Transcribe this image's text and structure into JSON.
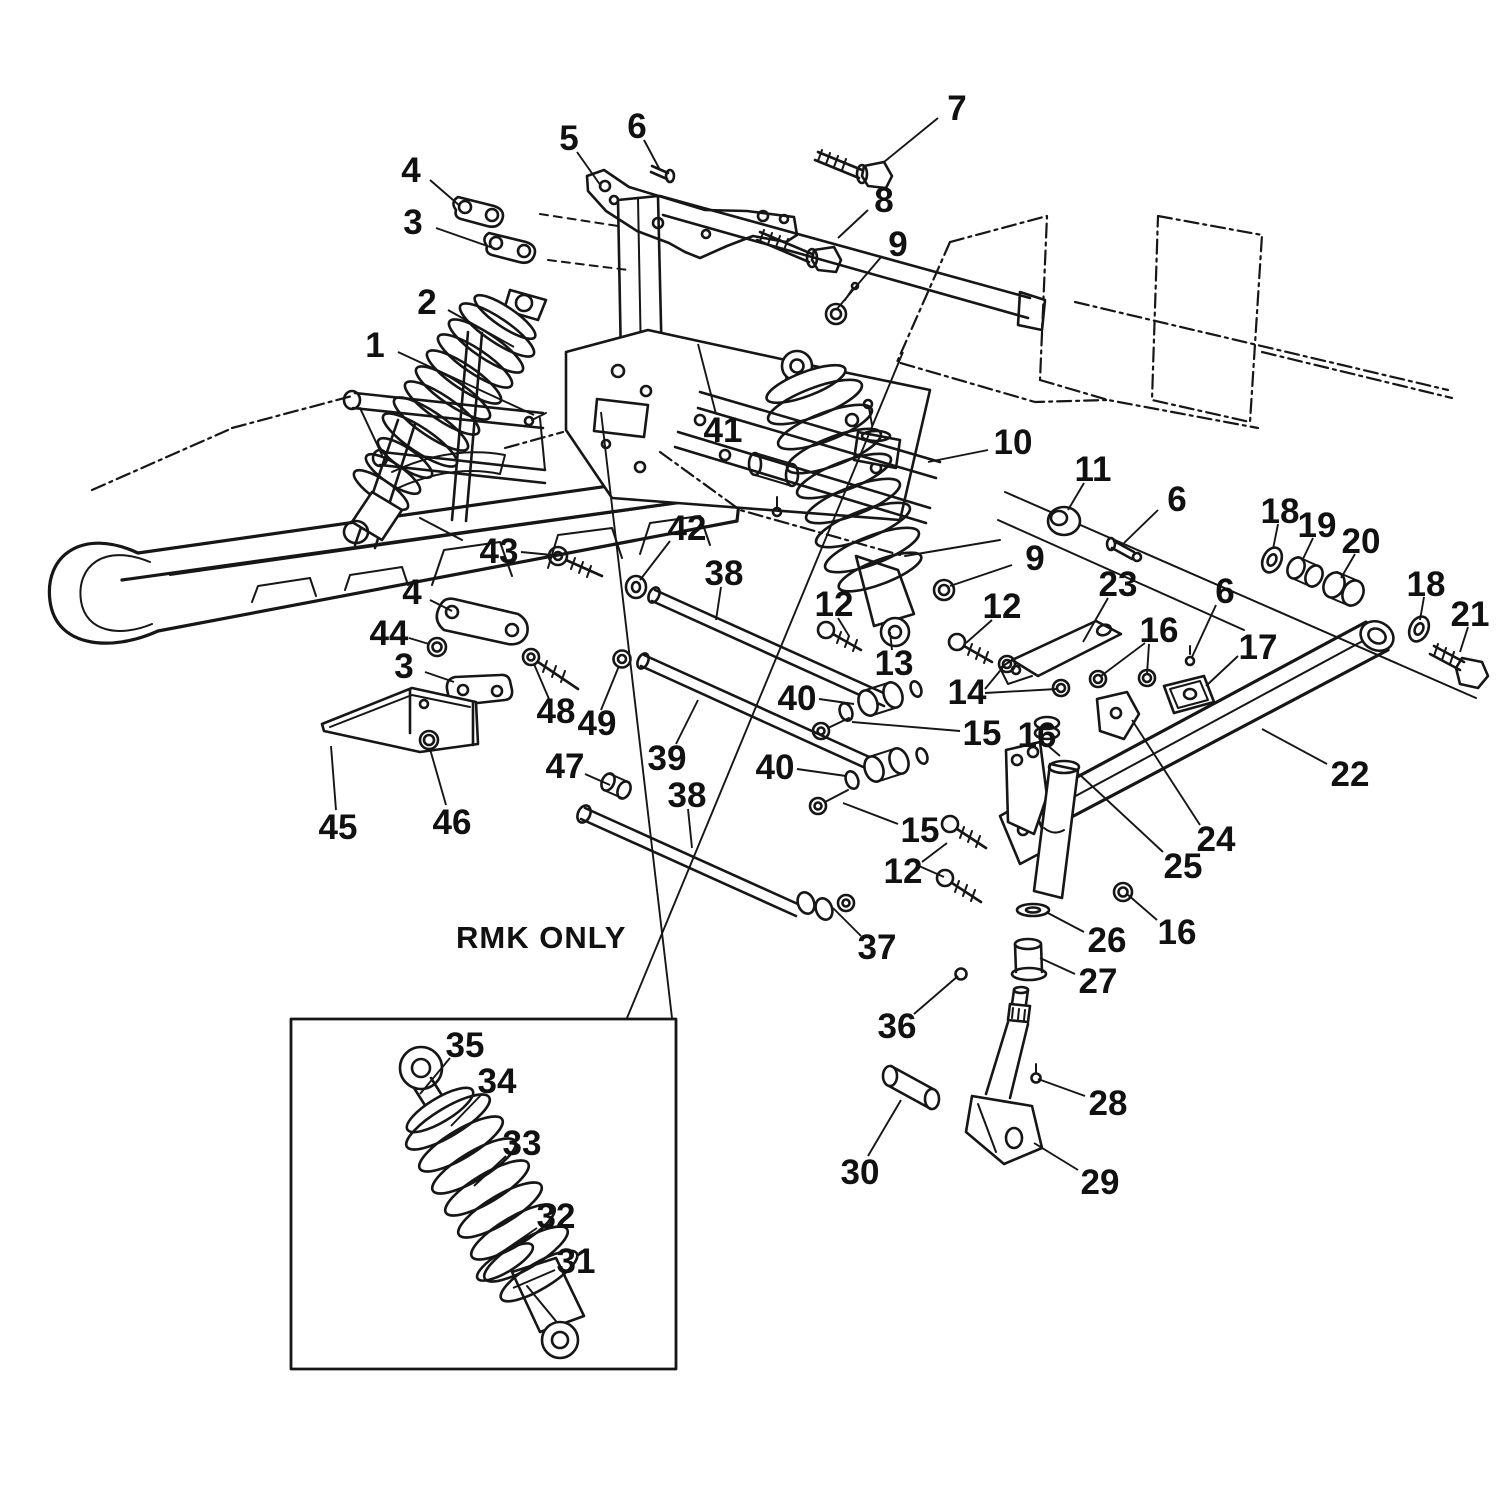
{
  "figure": {
    "note": "RMK ONLY",
    "background": "#ffffff",
    "line_color": "#161616"
  },
  "inset": {
    "x": 291,
    "y": 1019,
    "w": 385,
    "h": 350
  },
  "callouts": [
    {
      "n": "1",
      "x": 375,
      "y": 345,
      "lx": 398,
      "ly": 352,
      "tx": 534,
      "ty": 415
    },
    {
      "n": "2",
      "x": 427,
      "y": 302,
      "lx": 448,
      "ly": 310,
      "tx": 514,
      "ty": 347
    },
    {
      "n": "3",
      "x": 413,
      "y": 222,
      "lx": 436,
      "ly": 228,
      "tx": 496,
      "ty": 249
    },
    {
      "n": "4",
      "x": 411,
      "y": 170,
      "lx": 430,
      "ly": 180,
      "tx": 460,
      "ty": 206
    },
    {
      "n": "5",
      "x": 569,
      "y": 138,
      "lx": 577,
      "ly": 152,
      "tx": 601,
      "ty": 186
    },
    {
      "n": "6",
      "x": 637,
      "y": 126,
      "lx": 644,
      "ly": 140,
      "tx": 660,
      "ty": 170
    },
    {
      "n": "7",
      "x": 957,
      "y": 108,
      "lx": 938,
      "ly": 118,
      "tx": 884,
      "ty": 162
    },
    {
      "n": "8",
      "x": 884,
      "y": 200,
      "lx": 868,
      "ly": 210,
      "tx": 838,
      "ty": 238
    },
    {
      "n": "9",
      "x": 898,
      "y": 244,
      "lx": 882,
      "ly": 256,
      "tx": 836,
      "ty": 310
    },
    {
      "n": "10",
      "x": 1013,
      "y": 442,
      "lx": 988,
      "ly": 450,
      "tx": 928,
      "ty": 462
    },
    {
      "n": "11",
      "x": 1093,
      "y": 469,
      "lx": 1084,
      "ly": 483,
      "tx": 1068,
      "ty": 510
    },
    {
      "n": "6",
      "x": 1177,
      "y": 499,
      "lx": 1158,
      "ly": 510,
      "tx": 1124,
      "ty": 543
    },
    {
      "n": "9",
      "x": 1035,
      "y": 558,
      "lx": 1012,
      "ly": 565,
      "tx": 950,
      "ty": 586
    },
    {
      "n": "23",
      "x": 1118,
      "y": 584,
      "lx": 1108,
      "ly": 598,
      "tx": 1083,
      "ty": 642
    },
    {
      "n": "12",
      "x": 834,
      "y": 604,
      "lx": 838,
      "ly": 618,
      "tx": 849,
      "ty": 636
    },
    {
      "n": "12",
      "x": 1002,
      "y": 606,
      "lx": 992,
      "ly": 620,
      "tx": 966,
      "ty": 643
    },
    {
      "n": "13",
      "x": 894,
      "y": 663,
      "lx": 892,
      "ly": 650,
      "tx": 890,
      "ty": 632
    },
    {
      "n": "14",
      "x": 967,
      "y": 692,
      "lx": 985,
      "ly": 689,
      "tx": 1004,
      "ty": 666
    },
    {
      "n": "15",
      "x": 982,
      "y": 733,
      "lx": 960,
      "ly": 731,
      "tx": 852,
      "ty": 722
    },
    {
      "n": "16",
      "x": 1159,
      "y": 630,
      "lx": 1145,
      "ly": 643,
      "tx": 1101,
      "ty": 676
    },
    {
      "n": "6",
      "x": 1225,
      "y": 591,
      "lx": 1216,
      "ly": 605,
      "tx": 1192,
      "ty": 657
    },
    {
      "n": "17",
      "x": 1258,
      "y": 647,
      "lx": 1238,
      "ly": 656,
      "tx": 1206,
      "ty": 686
    },
    {
      "n": "18",
      "x": 1280,
      "y": 511,
      "lx": 1278,
      "ly": 524,
      "tx": 1273,
      "ty": 549
    },
    {
      "n": "19",
      "x": 1317,
      "y": 525,
      "lx": 1313,
      "ly": 538,
      "tx": 1302,
      "ty": 561
    },
    {
      "n": "20",
      "x": 1361,
      "y": 541,
      "lx": 1355,
      "ly": 554,
      "tx": 1341,
      "ty": 578
    },
    {
      "n": "18",
      "x": 1426,
      "y": 584,
      "lx": 1424,
      "ly": 597,
      "tx": 1420,
      "ty": 620
    },
    {
      "n": "21",
      "x": 1470,
      "y": 614,
      "lx": 1468,
      "ly": 627,
      "tx": 1460,
      "ly2": 0,
      "ty": 652
    },
    {
      "n": "22",
      "x": 1350,
      "y": 774,
      "lx": 1327,
      "ly": 764,
      "tx": 1262,
      "ty": 729
    },
    {
      "n": "24",
      "x": 1216,
      "y": 839,
      "lx": 1200,
      "ly": 825,
      "tx": 1132,
      "ty": 720
    },
    {
      "n": "25",
      "x": 1183,
      "y": 866,
      "lx": 1163,
      "ly": 852,
      "tx": 1079,
      "ty": 774
    },
    {
      "n": "16",
      "x": 1037,
      "y": 735,
      "lx": 1046,
      "ly": 744,
      "tx": 1060,
      "ty": 756
    },
    {
      "n": "12",
      "x": 903,
      "y": 871,
      "lx": 922,
      "ly": 862,
      "tx": 947,
      "ty": 843
    },
    {
      "n": "37",
      "x": 877,
      "y": 947,
      "lx": 861,
      "ly": 936,
      "tx": 833,
      "ty": 908
    },
    {
      "n": "36",
      "x": 897,
      "y": 1026,
      "lx": 914,
      "ly": 1014,
      "tx": 958,
      "ty": 976
    },
    {
      "n": "26",
      "x": 1107,
      "y": 940,
      "lx": 1084,
      "ly": 932,
      "tx": 1046,
      "ty": 912
    },
    {
      "n": "27",
      "x": 1098,
      "y": 981,
      "lx": 1075,
      "ly": 974,
      "tx": 1040,
      "ty": 958
    },
    {
      "n": "16",
      "x": 1177,
      "y": 932,
      "lx": 1157,
      "ly": 920,
      "tx": 1127,
      "ty": 894
    },
    {
      "n": "28",
      "x": 1108,
      "y": 1103,
      "lx": 1085,
      "ly": 1096,
      "tx": 1038,
      "ty": 1079
    },
    {
      "n": "29",
      "x": 1100,
      "y": 1182,
      "lx": 1078,
      "ly": 1170,
      "tx": 1034,
      "ty": 1143
    },
    {
      "n": "30",
      "x": 860,
      "y": 1172,
      "lx": 868,
      "ly": 1156,
      "tx": 901,
      "ty": 1100
    },
    {
      "n": "38",
      "x": 724,
      "y": 573,
      "lx": 721,
      "ly": 587,
      "tx": 716,
      "ty": 620
    },
    {
      "n": "39",
      "x": 667,
      "y": 758,
      "lx": 676,
      "ly": 744,
      "tx": 698,
      "ty": 700
    },
    {
      "n": "38",
      "x": 687,
      "y": 795,
      "lx": 688,
      "ly": 809,
      "tx": 692,
      "ty": 848
    },
    {
      "n": "40",
      "x": 797,
      "y": 698,
      "lx": 819,
      "ly": 699,
      "tx": 854,
      "ty": 704
    },
    {
      "n": "40",
      "x": 775,
      "y": 767,
      "lx": 797,
      "ly": 769,
      "tx": 846,
      "ty": 776
    },
    {
      "n": "15",
      "x": 920,
      "y": 830,
      "lx": 898,
      "ly": 824,
      "tx": 843,
      "ty": 803
    },
    {
      "n": "47",
      "x": 565,
      "y": 766,
      "lx": 585,
      "ly": 774,
      "tx": 610,
      "ty": 785
    },
    {
      "n": "48",
      "x": 556,
      "y": 711,
      "lx": 549,
      "ly": 699,
      "tx": 534,
      "ty": 664
    },
    {
      "n": "49",
      "x": 597,
      "y": 723,
      "lx": 601,
      "ly": 710,
      "tx": 619,
      "ty": 666
    },
    {
      "n": "41",
      "x": 723,
      "y": 430,
      "lx": 716,
      "ly": 414,
      "tx": 698,
      "ty": 344
    },
    {
      "n": "42",
      "x": 687,
      "y": 528,
      "lx": 670,
      "ly": 541,
      "tx": 640,
      "ty": 580
    },
    {
      "n": "43",
      "x": 499,
      "y": 551,
      "lx": 521,
      "ly": 552,
      "tx": 552,
      "ty": 555
    },
    {
      "n": "4",
      "x": 412,
      "y": 592,
      "lx": 430,
      "ly": 600,
      "tx": 452,
      "ty": 611
    },
    {
      "n": "44",
      "x": 389,
      "y": 633,
      "lx": 409,
      "ly": 638,
      "tx": 429,
      "ty": 644
    },
    {
      "n": "3",
      "x": 404,
      "y": 666,
      "lx": 425,
      "ly": 672,
      "tx": 454,
      "ty": 682
    },
    {
      "n": "45",
      "x": 338,
      "y": 827,
      "lx": 336,
      "ly": 810,
      "tx": 331,
      "ty": 746
    },
    {
      "n": "46",
      "x": 452,
      "y": 822,
      "lx": 446,
      "ly": 805,
      "tx": 430,
      "ty": 749
    },
    {
      "n": "35",
      "x": 465,
      "y": 1045,
      "lx": 450,
      "ly": 1058,
      "tx": 420,
      "ty": 1094
    },
    {
      "n": "34",
      "x": 497,
      "y": 1081,
      "lx": 482,
      "ly": 1094,
      "tx": 451,
      "ty": 1126
    },
    {
      "n": "33",
      "x": 522,
      "y": 1143,
      "lx": 506,
      "ly": 1156,
      "tx": 474,
      "ty": 1186
    },
    {
      "n": "32",
      "x": 556,
      "y": 1216,
      "lx": 537,
      "ly": 1228,
      "tx": 502,
      "ty": 1252
    },
    {
      "n": "31",
      "x": 576,
      "y": 1261,
      "lx": 555,
      "ly": 1270,
      "tx": 513,
      "ty": 1288
    }
  ],
  "extra_leaders": [
    {
      "x1": 985,
      "y1": 693,
      "x2": 1057,
      "y2": 689
    },
    {
      "x1": 1149,
      "y1": 644,
      "x2": 1147,
      "y2": 674
    },
    {
      "x1": 919,
      "y1": 866,
      "x2": 944,
      "y2": 877
    },
    {
      "x1": 903,
      "y1": 352,
      "x2": 627,
      "y2": 1018
    },
    {
      "x1": 601,
      "y1": 412,
      "x2": 672,
      "y2": 1018
    }
  ]
}
